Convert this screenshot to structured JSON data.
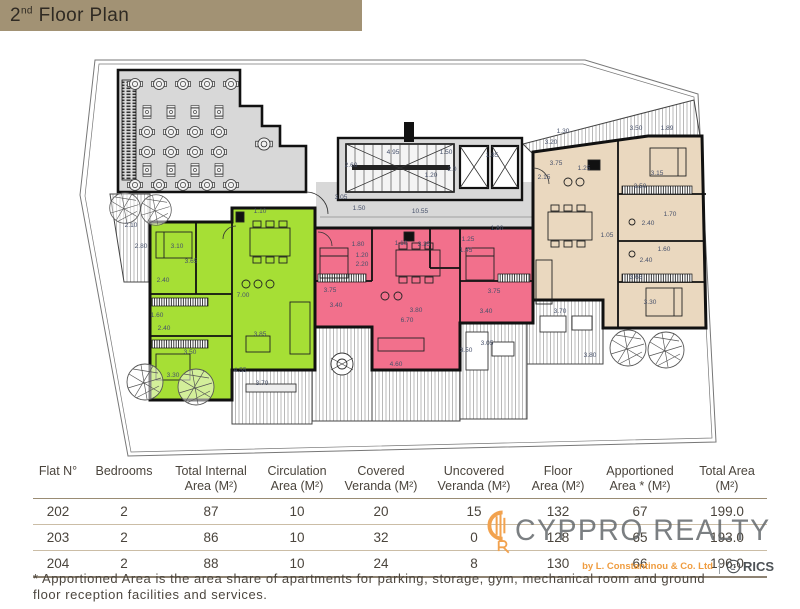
{
  "header": {
    "title_main": "2",
    "title_sup": "nd",
    "title_rest": " Floor Plan"
  },
  "plan": {
    "colors": {
      "flat_202": "#a6df35",
      "flat_203": "#f2708c",
      "flat_204": "#ead8bf",
      "common": "#d8d8d8",
      "dim_text": "#46506a",
      "wall": "#111111"
    },
    "legend": {
      "flat_202_color_means": "Flat 202",
      "flat_203_color_means": "Flat 203",
      "flat_204_color_means": "Flat 204"
    },
    "dimensions": [
      {
        "t": "3.05",
        "x": 341,
        "y": 163
      },
      {
        "t": "1.50",
        "x": 359,
        "y": 174
      },
      {
        "t": "10.55",
        "x": 420,
        "y": 177
      },
      {
        "t": "4.95",
        "x": 393,
        "y": 118
      },
      {
        "t": "2.60",
        "x": 351,
        "y": 131
      },
      {
        "t": "1.50",
        "x": 446,
        "y": 118
      },
      {
        "t": "1.85",
        "x": 492,
        "y": 121
      },
      {
        "t": "2.0",
        "x": 452,
        "y": 135
      },
      {
        "t": "1.20",
        "x": 431,
        "y": 141
      },
      {
        "t": "1.30",
        "x": 563,
        "y": 97
      },
      {
        "t": "3.20",
        "x": 551,
        "y": 108
      },
      {
        "t": "3.50",
        "x": 636,
        "y": 94
      },
      {
        "t": "1.89",
        "x": 667,
        "y": 94
      },
      {
        "t": "3.75",
        "x": 556,
        "y": 129
      },
      {
        "t": "1.25",
        "x": 584,
        "y": 134
      },
      {
        "t": "2.15",
        "x": 544,
        "y": 143
      },
      {
        "t": "3.50",
        "x": 640,
        "y": 152
      },
      {
        "t": "3.15",
        "x": 657,
        "y": 139
      },
      {
        "t": "1.05",
        "x": 607,
        "y": 201
      },
      {
        "t": "2.40",
        "x": 648,
        "y": 189
      },
      {
        "t": "1.70",
        "x": 670,
        "y": 180
      },
      {
        "t": "1.60",
        "x": 664,
        "y": 215
      },
      {
        "t": "2.40",
        "x": 646,
        "y": 226
      },
      {
        "t": "3.65",
        "x": 636,
        "y": 243
      },
      {
        "t": "3.30",
        "x": 650,
        "y": 268
      },
      {
        "t": "1.10",
        "x": 260,
        "y": 177
      },
      {
        "t": "3.10",
        "x": 177,
        "y": 212
      },
      {
        "t": "3.65",
        "x": 191,
        "y": 227
      },
      {
        "t": "7.00",
        "x": 243,
        "y": 261
      },
      {
        "t": "2.40",
        "x": 163,
        "y": 246
      },
      {
        "t": "1.60",
        "x": 157,
        "y": 281
      },
      {
        "t": "2.40",
        "x": 164,
        "y": 294
      },
      {
        "t": "3.50",
        "x": 190,
        "y": 318
      },
      {
        "t": "3.30",
        "x": 173,
        "y": 341
      },
      {
        "t": "3.85",
        "x": 260,
        "y": 300
      },
      {
        "t": "1.80",
        "x": 358,
        "y": 210
      },
      {
        "t": "1.20",
        "x": 362,
        "y": 221
      },
      {
        "t": "2.20",
        "x": 362,
        "y": 230
      },
      {
        "t": "1.10",
        "x": 401,
        "y": 209
      },
      {
        "t": "3.35",
        "x": 424,
        "y": 210
      },
      {
        "t": "3.75",
        "x": 330,
        "y": 256
      },
      {
        "t": "3.40",
        "x": 336,
        "y": 271
      },
      {
        "t": "3.80",
        "x": 416,
        "y": 276
      },
      {
        "t": "6.70",
        "x": 407,
        "y": 286
      },
      {
        "t": "1.25",
        "x": 468,
        "y": 205
      },
      {
        "t": "1.45",
        "x": 466,
        "y": 216
      },
      {
        "t": "1.80",
        "x": 497,
        "y": 194
      },
      {
        "t": "3.75",
        "x": 494,
        "y": 257
      },
      {
        "t": "3.40",
        "x": 486,
        "y": 277
      },
      {
        "t": "2.10",
        "x": 131,
        "y": 191
      },
      {
        "t": "2.80",
        "x": 141,
        "y": 212
      },
      {
        "t": "4.55",
        "x": 240,
        "y": 336
      },
      {
        "t": "3.70",
        "x": 262,
        "y": 349
      },
      {
        "t": "3.05",
        "x": 487,
        "y": 309
      },
      {
        "t": "3.50",
        "x": 466,
        "y": 316
      },
      {
        "t": "4.60",
        "x": 396,
        "y": 330
      },
      {
        "t": "3.70",
        "x": 560,
        "y": 277
      },
      {
        "t": "3.80",
        "x": 590,
        "y": 321
      }
    ]
  },
  "table": {
    "columns": [
      {
        "l1": "Flat N°",
        "l2": ""
      },
      {
        "l1": "Bedrooms",
        "l2": ""
      },
      {
        "l1": "Total Internal",
        "l2": "Area (M²)"
      },
      {
        "l1": "Circulation",
        "l2": "Area (M²)"
      },
      {
        "l1": "Covered",
        "l2": "Veranda (M²)"
      },
      {
        "l1": "Uncovered",
        "l2": "Veranda (M²)"
      },
      {
        "l1": "Floor",
        "l2": "Area (M²)"
      },
      {
        "l1": "Apportioned",
        "l2": "Area * (M²)"
      },
      {
        "l1": "Total Area",
        "l2": "(M²)"
      }
    ],
    "rows": [
      [
        "202",
        "2",
        "87",
        "10",
        "20",
        "15",
        "132",
        "67",
        "199.0"
      ],
      [
        "203",
        "2",
        "86",
        "10",
        "32",
        "0",
        "128",
        "65",
        "193.0"
      ],
      [
        "204",
        "2",
        "88",
        "10",
        "24",
        "8",
        "130",
        "66",
        "196.0"
      ]
    ]
  },
  "watermark": {
    "brand": "CYPPRO REALTY",
    "byline": "by L. Constantinou & Co. Ltd",
    "rics": "RICS",
    "accent": "#f2a24e"
  },
  "footnote": {
    "line1": "* Apportioned Area is the area share of apartments for parking, storage, gym, mechanical room and ground",
    "line2": "floor reception facilities and services."
  }
}
